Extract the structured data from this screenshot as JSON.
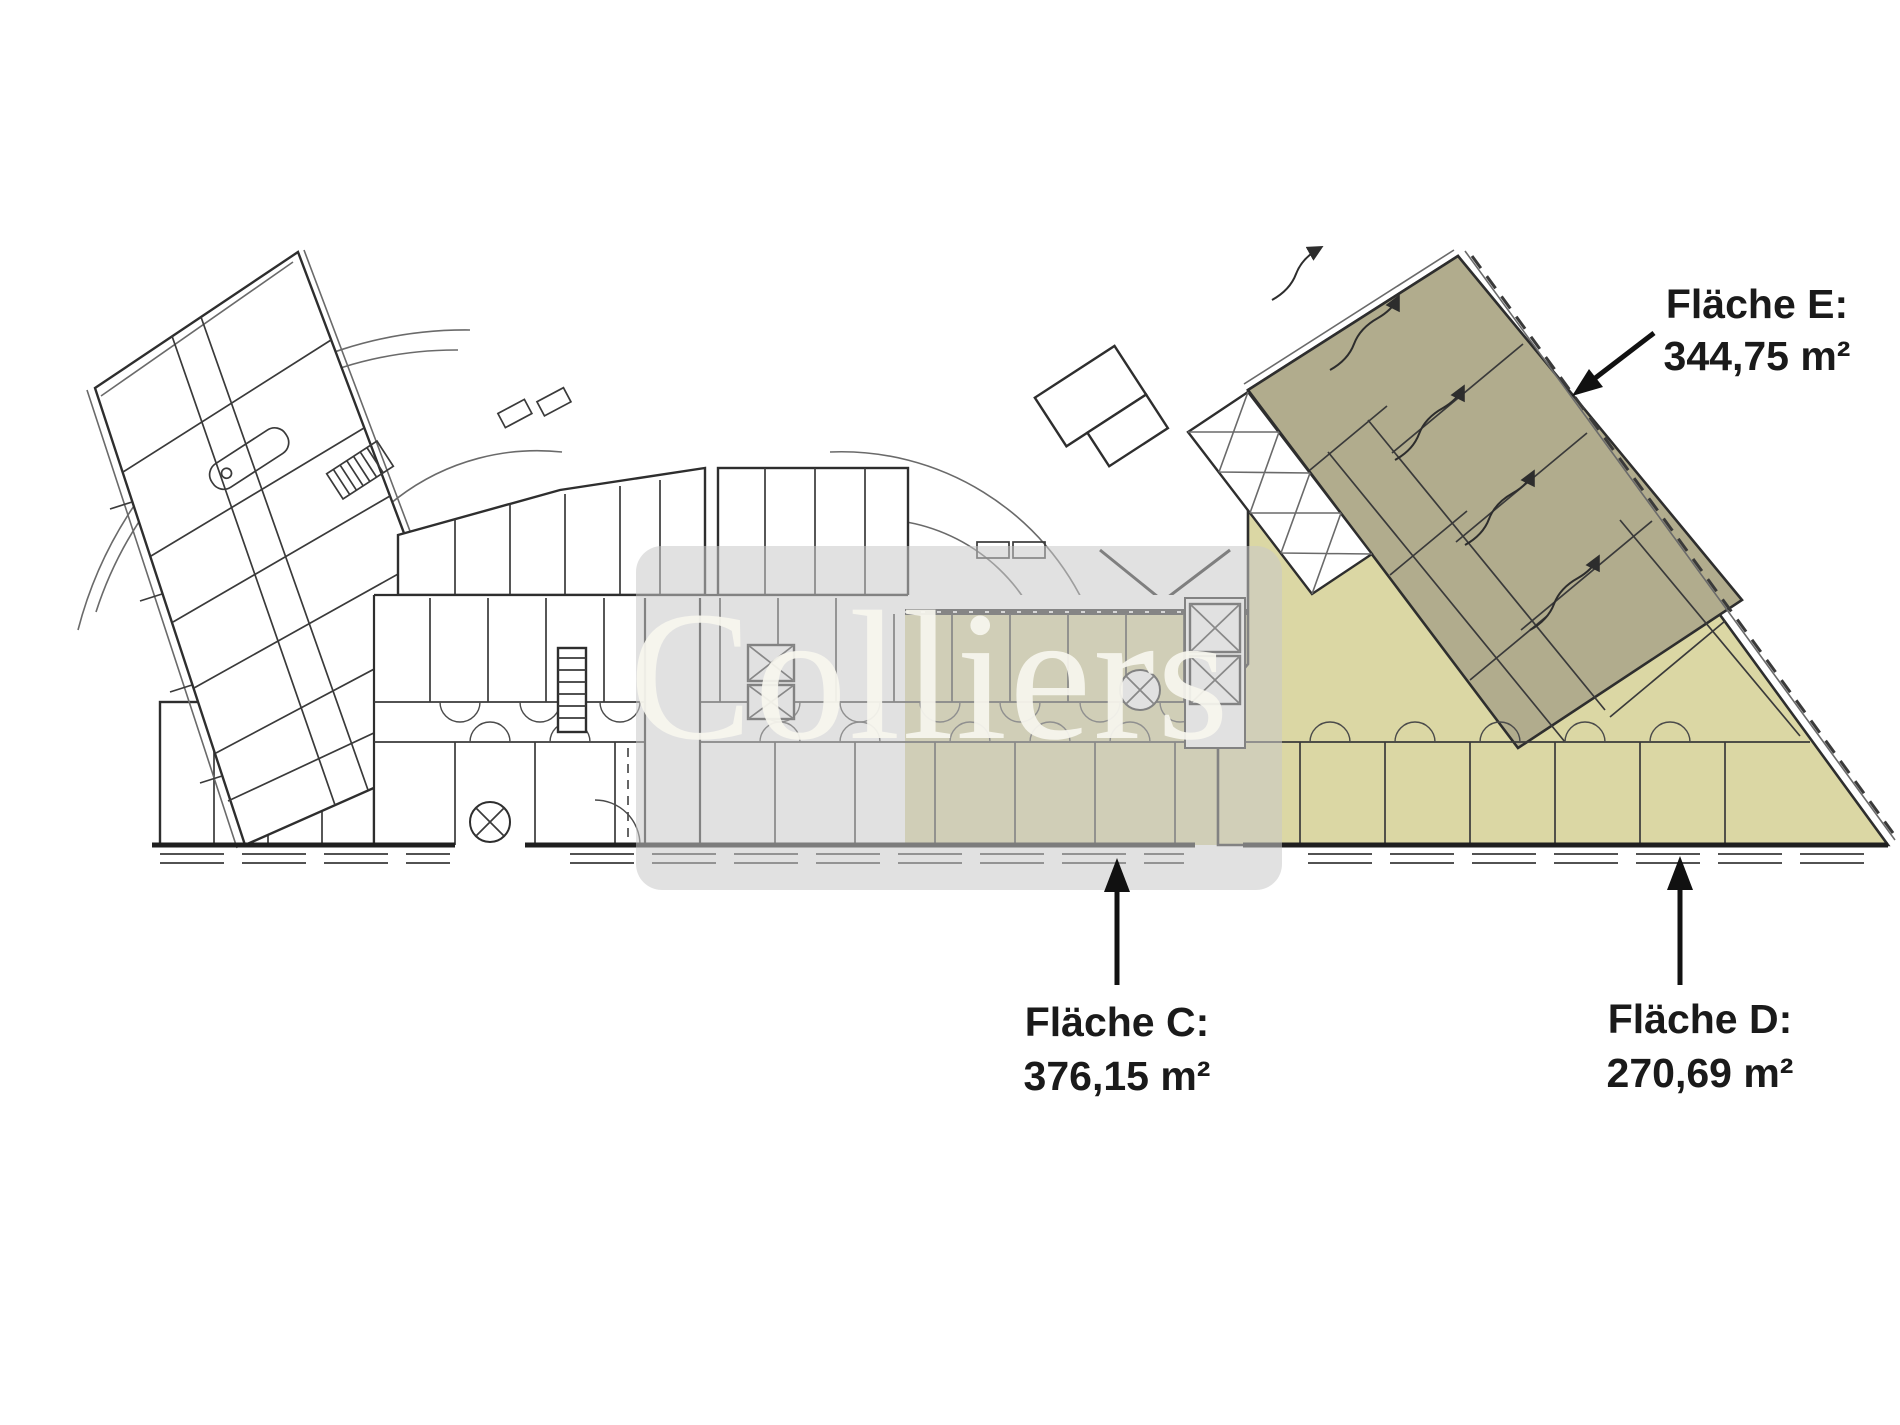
{
  "watermark": {
    "text": "Colliers"
  },
  "areas": {
    "e": {
      "name": "Fläche E:",
      "value": "344,75 m²"
    },
    "c": {
      "name": "Fläche C:",
      "value": "376,15 m²"
    },
    "d": {
      "name": "Fläche D:",
      "value": "270,69 m²"
    }
  },
  "colors": {
    "area_e_fill": "#b1ac8d",
    "area_c_fill": "#d9d5a2",
    "area_d_fill": "#dbd7a4",
    "watermark_band": "#c9c9c9",
    "watermark_text": "#f8f7ef",
    "label_text": "#1a1a1a",
    "arrow": "#111111"
  }
}
